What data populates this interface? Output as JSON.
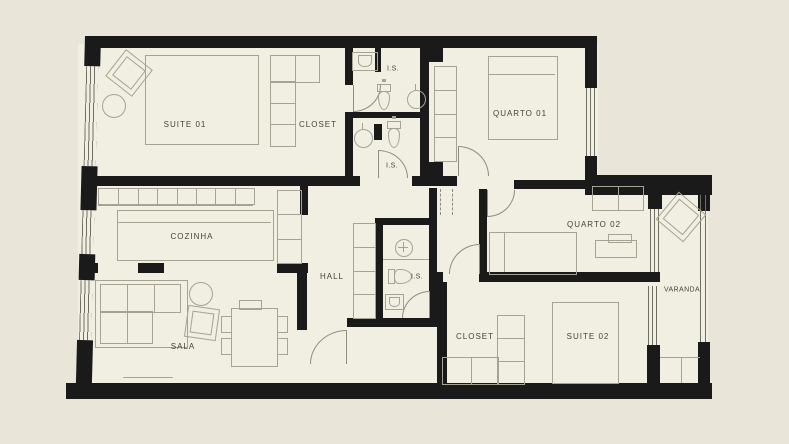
{
  "title": "apartment-floor-plan",
  "colors": {
    "bg": "#e9e5d8",
    "floor": "#f1eee2",
    "wall": "#1a1a1a",
    "ln": "#a6a392",
    "door": "#8f8d7e",
    "win": "#6f6e62",
    "txt": "#45453c"
  },
  "labels": {
    "suite01": "SUITE 01",
    "closet01": "CLOSET",
    "is1": "I.S.",
    "is2": "I.S.",
    "quarto01": "QUARTO 01",
    "cozinha": "COZINHA",
    "hall": "HALL",
    "is3": "I.S.",
    "quarto02": "QUARTO 02",
    "sala": "SALA",
    "closet02": "CLOSET",
    "suite02": "SUITE 02",
    "varanda": "VARANDA"
  }
}
